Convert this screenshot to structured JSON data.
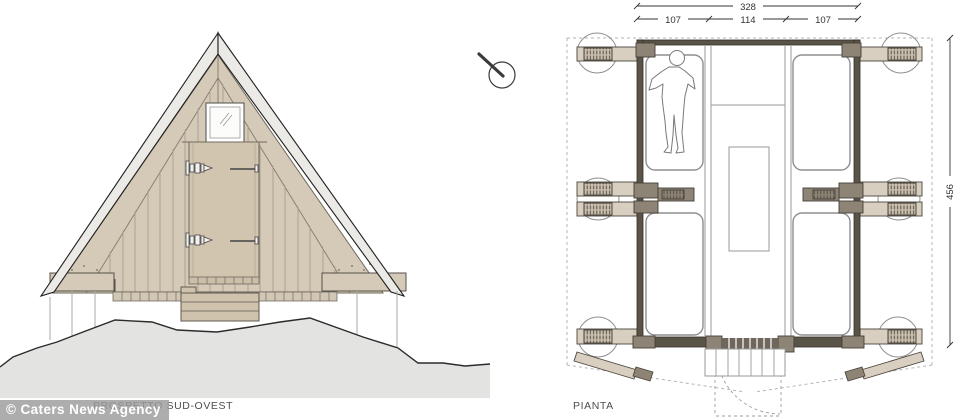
{
  "title": "A-frame mountain hut technical drawing",
  "panels": {
    "elevation": {
      "label": "PROSPETTO SUD-OVEST"
    },
    "plan": {
      "label": "PIANTA"
    }
  },
  "watermark": {
    "text": "© Caters News Agency"
  },
  "dimensions": {
    "plan_total_width": "328",
    "plan_left_bay": "107",
    "plan_center_bay": "114",
    "plan_right_bay": "107",
    "plan_depth": "456"
  },
  "icons": {
    "compass": "north-compass-icon"
  },
  "colors": {
    "wood_tan": "#d5cab7",
    "wood_beam_tan": "#d8cfc0",
    "wood_dark_olive": "#8d8475",
    "wall_dark": "#5a5347",
    "roof_band_gray": "#eceae6",
    "terrain_gray": "#e3e3e1",
    "outline_dark": "#2e2e2e"
  }
}
